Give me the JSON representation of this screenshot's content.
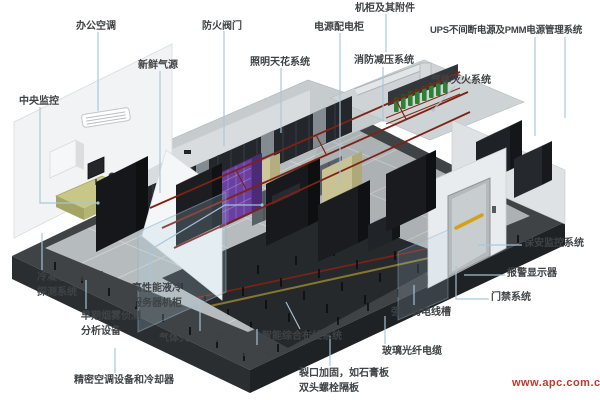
{
  "diagram_title": "APC 数据中心机房系统示意图",
  "watermark": "www.apc.com.cn",
  "colors": {
    "connector_line": "#a6c6dc",
    "label_text": "#3f4345",
    "watermark": "#c0392b",
    "rack_purple": "#6a3fa2",
    "gas_bottle_green": "#2d8034",
    "cable_tray_red": "#7e2214",
    "desk_yellow": "#c8c787",
    "floor_gray": "#b6bbbd"
  },
  "labels": {
    "central_monitoring": "中央监控",
    "office_ac": "办公空调",
    "fresh_air": "新鲜气源",
    "fire_valve": "防火阀门",
    "lighting_ceiling": "照明天花系统",
    "power_distribution": "电源配电柜",
    "cabinet_accessories": "机柜及其附件",
    "fire_pressure_relief": "消防减压系统",
    "ups_pmm": "UPS不间断电源及PMM电源管理系统",
    "gas_suppression": "气体灭火系统",
    "security_monitoring": "保安监控系统",
    "alarm_display": "报警显示器",
    "access_control": "门禁系统",
    "strong_weak_trunking": "强、弱电线槽",
    "fiber_optic_cable": "玻璃光纤电缆",
    "opening_reinforcement": "裂口加固，如石膏板\n双头螺栓隔板",
    "smart_cabling": "智能综合布线系统",
    "raised_floor": "高架地板",
    "gas_pipe_network": "气体灭火系统管网",
    "condensate_leak_detection": "冷凝水盘带漏水\n探测系统",
    "hp_liquid_cooled_rack": "高性能液冷\n服务器机柜",
    "early_smoke_detection": "早期烟雾侦测\n分析设备",
    "precision_ac_cooler": "精密空调设备和冷却器"
  }
}
